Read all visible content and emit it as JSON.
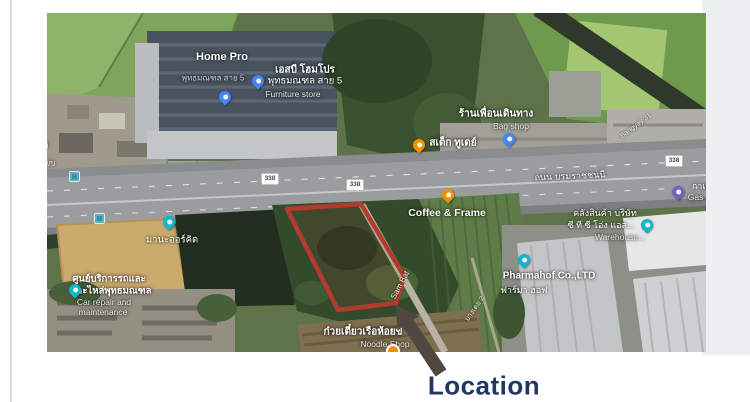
{
  "annotation": {
    "location_label": "Location"
  },
  "map": {
    "road": {
      "name": "ถนน บรมราชชนนี",
      "route_number": "338"
    },
    "streets": {
      "sam_bat": "Sam Bat",
      "bangyay": "Bangyay 31",
      "bang_toei": "บางเตย 2"
    },
    "places": {
      "home_pro": {
        "title": "Home Pro",
        "subtitle": "พุทธมณฑล สาย 5"
      },
      "furniture": {
        "line1": "เอสบี โฮมโปร",
        "line2": "พุทธมณฑล สาย 5",
        "eng": "Furniture store"
      },
      "bag_shop": {
        "line1": "ร้านเพื่อนเดินทาง",
        "eng": "Bag shop"
      },
      "steak": {
        "line1": "สเต็ก ทูเดย์"
      },
      "coffee": {
        "line1": "Coffee & Frame"
      },
      "warehouse": {
        "line1": "คลังสินค้า บริษัท",
        "line2": "ซี ที ซี โอ่ง แอส...",
        "eng": "Warehouse..."
      },
      "gas": {
        "line1": "กาแ",
        "eng": "Gas s."
      },
      "pharmahof": {
        "line1": "Pharmahof Co.,LTD",
        "line2": "ฟาร์มา ฮอฟ"
      },
      "noodle": {
        "line1": "ก๋วยเตี๋ยวเรือห้อยขี",
        "eng": "Noodle Shop"
      },
      "orchid": {
        "line1": "มานะออร์คิด"
      },
      "car_repair": {
        "line1": "ศูนย์บริการรถและ",
        "line2": "อะไหล่พุทธมณฑล",
        "eng1": "Car repair and",
        "eng2": "maintenance"
      },
      "edge_partial": {
        "line1": "ที",
        "line2": "เยบ"
      }
    },
    "colors": {
      "pin_blue": "#4285f4",
      "pin_teal": "#12b5cb",
      "pin_orange": "#f09300",
      "pin_purple": "#6f5fc6",
      "boundary_red": "#b23b2e",
      "arrow_gray": "#4e4742",
      "location_text": "#1f3864"
    }
  }
}
